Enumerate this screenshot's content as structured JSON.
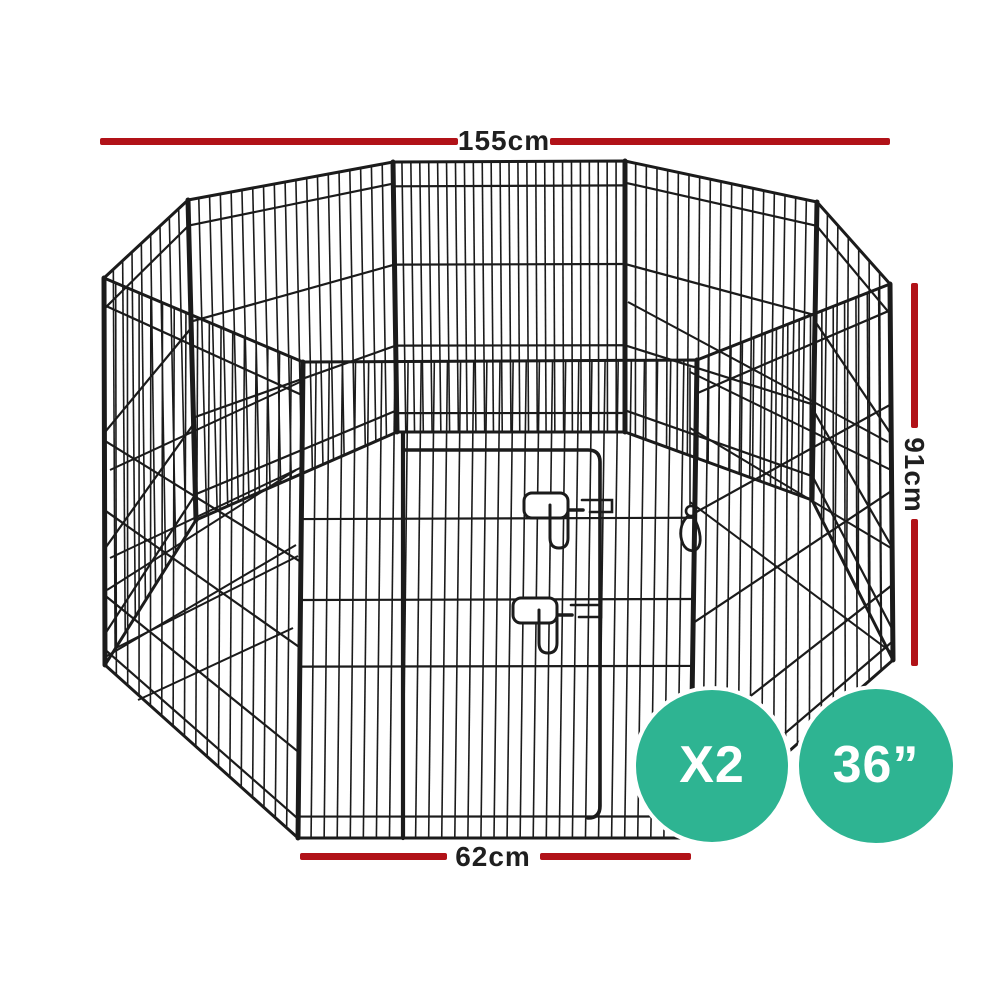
{
  "illustration": {
    "subject": "octagonal-wire-pet-playpen-line-drawing",
    "parts": [
      "wire-mesh-panels",
      "door-frame",
      "door-latch",
      "snap-hook"
    ]
  },
  "colors": {
    "accent_red": "#b11218",
    "badge_teal": "#2eb492",
    "wire": "#1b1b1b",
    "label_text": "#1f1f1f",
    "badge_text": "#ffffff",
    "background": "#ffffff"
  },
  "dimensions": {
    "width_label": "155cm",
    "height_label": "91cm",
    "panel_width_label": "62cm"
  },
  "badges": [
    {
      "label": "X2"
    },
    {
      "label": "36”"
    }
  ]
}
